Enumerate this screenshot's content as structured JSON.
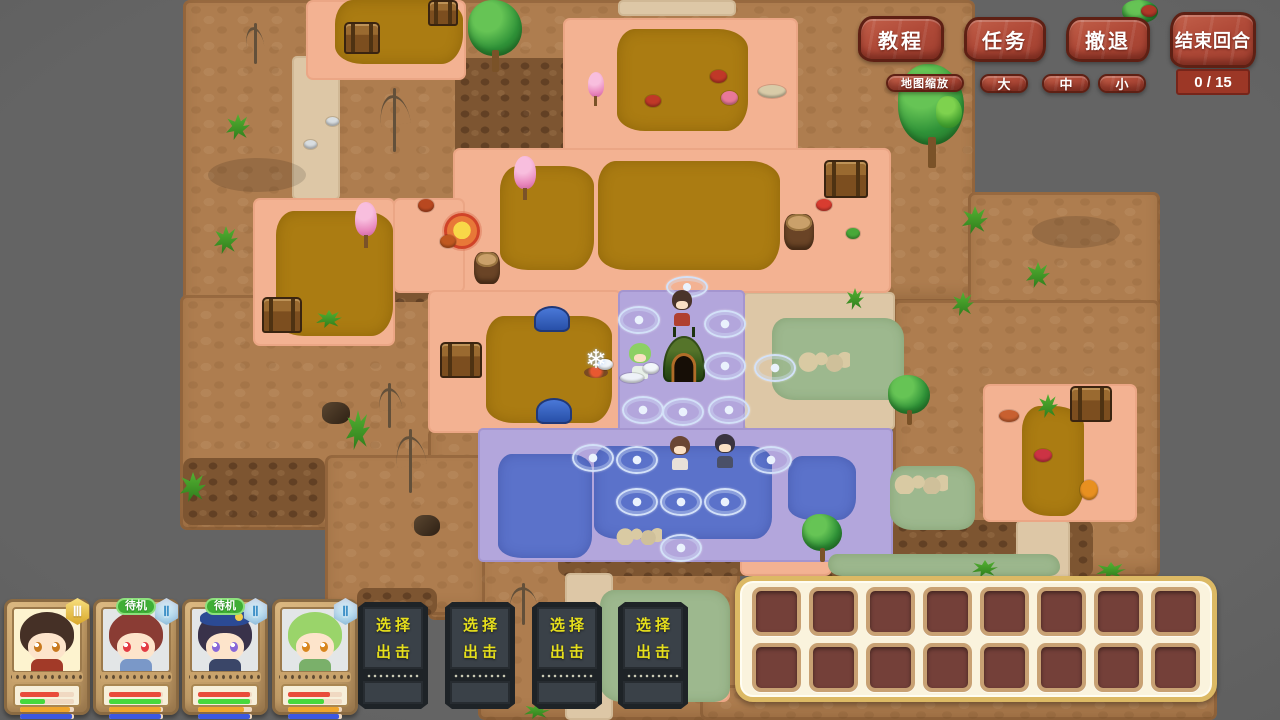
{
  "hud": {
    "buttons": [
      {
        "id": "tutorial",
        "label": "教程"
      },
      {
        "id": "tasks",
        "label": "任务"
      },
      {
        "id": "retreat",
        "label": "撤退"
      },
      {
        "id": "end-turn",
        "label": "结束回合"
      }
    ],
    "turn_counter": "0 / 15",
    "map_zoom": {
      "label": "地图缩放",
      "options": [
        "大",
        "中",
        "小"
      ]
    },
    "accent_color": "#b04a38"
  },
  "party": {
    "standby_label": "待机",
    "sortie_label": [
      "选择",
      "出击"
    ],
    "sortie_slot_count": 4,
    "cards": [
      {
        "id": "char-1",
        "standby": false,
        "badge": "Ⅲ",
        "badge_style": "gold",
        "bg": "#fdf3cf",
        "hair": "#453026",
        "eye": "#c8791f",
        "outfit": "#a23a28",
        "hat": null,
        "bars": [
          {
            "color": "#e94b3b",
            "pct": 72
          },
          {
            "color": "#46d93c",
            "pct": 46
          },
          {
            "color": "#f0a62d",
            "pct": 93
          },
          {
            "color": "#3c58e0",
            "pct": 96
          }
        ]
      },
      {
        "id": "char-2",
        "standby": true,
        "badge": "Ⅱ",
        "badge_style": "blue",
        "bg": "#e3e6e7",
        "hair": "#8a3c34",
        "eye": "#e23b44",
        "outfit": "#7a98c8",
        "hat": null,
        "bars": [
          {
            "color": "#e94b3b",
            "pct": 97
          },
          {
            "color": "#46d93c",
            "pct": 97
          },
          {
            "color": "#f0a62d",
            "pct": 97
          },
          {
            "color": "#3c58e0",
            "pct": 97
          }
        ]
      },
      {
        "id": "char-3",
        "standby": true,
        "badge": "Ⅱ",
        "badge_style": "blue",
        "bg": "#e3e6e7",
        "hair": "#39324a",
        "eye": "#8868d8",
        "outfit": "#3a4668",
        "hat": "#2b4a94",
        "bars": [
          {
            "color": "#e94b3b",
            "pct": 97
          },
          {
            "color": "#46d93c",
            "pct": 97
          },
          {
            "color": "#f0a62d",
            "pct": 85
          },
          {
            "color": "#3c58e0",
            "pct": 97
          }
        ]
      },
      {
        "id": "char-4",
        "standby": false,
        "badge": "Ⅱ",
        "badge_style": "blue",
        "bg": "#e3e6e7",
        "hair": "#9ad46a",
        "eye": "#d8861e",
        "outfit": "#7ab06a",
        "hat": null,
        "bars": [
          {
            "color": "#e94b3b",
            "pct": 78
          },
          {
            "color": "#46d93c",
            "pct": 66
          },
          {
            "color": "#f0a62d",
            "pct": 95
          },
          {
            "color": "#3c58e0",
            "pct": 95
          }
        ]
      }
    ]
  },
  "inventory": {
    "rows": 2,
    "cols": 8
  },
  "map": {
    "palette": {
      "brown": "#ae7d4f",
      "cliff": "#7d5531",
      "beige": "#ddc7a6",
      "pink": "#f3b292",
      "mustard": "#ab7c12",
      "purple": "#b3a6dc",
      "blue": "#5b72ca",
      "green": "#9db88e",
      "background": "#5e5e5e"
    },
    "regions": [
      [
        "brown",
        183,
        0,
        147,
        530
      ],
      [
        "brown",
        330,
        0,
        645,
        302
      ],
      [
        "brown",
        180,
        295,
        302,
        235
      ],
      [
        "brown",
        968,
        192,
        192,
        155
      ],
      [
        "brown",
        893,
        300,
        267,
        277
      ],
      [
        "brown",
        428,
        428,
        62,
        192
      ],
      [
        "brown",
        478,
        550,
        262,
        170
      ],
      [
        "brown",
        325,
        455,
        160,
        160
      ],
      [
        "brown",
        700,
        685,
        517,
        35
      ],
      [
        "cliff",
        455,
        58,
        118,
        155
      ],
      [
        "cliff",
        183,
        458,
        142,
        67
      ],
      [
        "cliff",
        330,
        246,
        100,
        56
      ],
      [
        "cliff",
        357,
        588,
        80,
        27
      ],
      [
        "cliff",
        558,
        536,
        335,
        40
      ],
      [
        "cliff",
        893,
        520,
        200,
        57
      ],
      [
        "beige",
        292,
        56,
        48,
        144
      ],
      [
        "beige",
        618,
        0,
        118,
        16
      ],
      [
        "beige",
        548,
        190,
        30,
        102
      ],
      [
        "beige",
        743,
        292,
        152,
        138
      ],
      [
        "beige",
        565,
        573,
        48,
        147
      ],
      [
        "beige",
        1016,
        520,
        54,
        60
      ],
      [
        "pink",
        306,
        0,
        160,
        80
      ],
      [
        "pink",
        563,
        18,
        235,
        138
      ],
      [
        "pink",
        453,
        148,
        438,
        145
      ],
      [
        "pink",
        253,
        198,
        142,
        148
      ],
      [
        "pink",
        393,
        198,
        72,
        95
      ],
      [
        "pink",
        428,
        290,
        194,
        143
      ],
      [
        "pink",
        983,
        384,
        154,
        138
      ],
      [
        "pink",
        740,
        556,
        92,
        20
      ],
      [
        "pink",
        687,
        607,
        43,
        95
      ],
      [
        "mustard",
        335,
        0,
        128,
        64
      ],
      [
        "mustard",
        617,
        29,
        131,
        102
      ],
      [
        "mustard",
        500,
        166,
        94,
        104
      ],
      [
        "mustard",
        598,
        161,
        182,
        109
      ],
      [
        "mustard",
        276,
        211,
        117,
        125
      ],
      [
        "mustard",
        486,
        316,
        126,
        107
      ],
      [
        "mustard",
        1022,
        406,
        62,
        110
      ],
      [
        "purple",
        618,
        290,
        127,
        145
      ],
      [
        "purple",
        478,
        428,
        415,
        134
      ],
      [
        "blue",
        498,
        454,
        94,
        104
      ],
      [
        "blue",
        594,
        446,
        178,
        93
      ],
      [
        "blue",
        788,
        456,
        68,
        64
      ],
      [
        "green",
        772,
        318,
        132,
        82
      ],
      [
        "green",
        890,
        466,
        85,
        64
      ],
      [
        "green",
        828,
        554,
        232,
        22
      ],
      [
        "green",
        600,
        590,
        130,
        112
      ],
      [
        "shade",
        208,
        158,
        98,
        34
      ],
      [
        "shade",
        1032,
        216,
        88,
        32
      ]
    ],
    "objects": [
      [
        "chest",
        344,
        22,
        32,
        28
      ],
      [
        "chest",
        428,
        0,
        26,
        22
      ],
      [
        "chest",
        824,
        160,
        40,
        34
      ],
      [
        "chest",
        262,
        297,
        36,
        32
      ],
      [
        "chest",
        440,
        342,
        38,
        32
      ],
      [
        "chest",
        1070,
        386,
        38,
        32
      ],
      [
        "tree",
        468,
        0,
        54,
        72
      ],
      [
        "tree",
        898,
        64,
        66,
        104
      ],
      [
        "tree",
        888,
        375,
        42,
        50
      ],
      [
        "tree",
        802,
        514,
        40,
        48
      ],
      [
        "tree",
        1122,
        0,
        36,
        30
      ],
      [
        "bush",
        936,
        96,
        26,
        32
      ],
      [
        "pinktree",
        585,
        72,
        22,
        34
      ],
      [
        "pinktree",
        511,
        156,
        28,
        44
      ],
      [
        "pinktree",
        352,
        202,
        28,
        46
      ],
      [
        "tent",
        663,
        336,
        42,
        46
      ],
      [
        "campfire",
        576,
        350,
        40,
        30
      ],
      [
        "shell",
        534,
        306,
        32,
        22
      ],
      [
        "shell",
        536,
        398,
        32,
        22
      ],
      [
        "spinner",
        444,
        213,
        30,
        30
      ],
      [
        "stump",
        474,
        252,
        26,
        32
      ],
      [
        "stump",
        784,
        214,
        30,
        36
      ],
      [
        "rock",
        322,
        402,
        28,
        22
      ],
      [
        "rock",
        414,
        515,
        26,
        21
      ],
      [
        "bones",
        798,
        350,
        52,
        22
      ],
      [
        "bones",
        616,
        527,
        46,
        18
      ],
      [
        "bones",
        894,
        474,
        54,
        20
      ],
      [
        "deadtree",
        374,
        380,
        30,
        48
      ],
      [
        "deadtree",
        390,
        425,
        40,
        68
      ],
      [
        "deadtree",
        374,
        84,
        40,
        68
      ],
      [
        "deadtree",
        505,
        580,
        36,
        45
      ],
      [
        "deadtree",
        242,
        20,
        24,
        44
      ],
      [
        "plant",
        226,
        114,
        24,
        26
      ],
      [
        "plant",
        214,
        226,
        24,
        28
      ],
      [
        "plant",
        180,
        472,
        26,
        30
      ],
      [
        "plant",
        962,
        206,
        26,
        28
      ],
      [
        "plant",
        1026,
        262,
        24,
        26
      ],
      [
        "plant",
        952,
        292,
        22,
        24
      ],
      [
        "plant",
        846,
        288,
        18,
        22
      ],
      [
        "plant",
        346,
        410,
        24,
        40
      ],
      [
        "plant",
        316,
        310,
        26,
        18
      ],
      [
        "plant",
        1038,
        394,
        20,
        24
      ],
      [
        "plant",
        972,
        560,
        26,
        17
      ],
      [
        "plant",
        1096,
        562,
        30,
        17
      ],
      [
        "plant",
        524,
        703,
        26,
        16
      ],
      [
        "snowflake",
        618,
        306,
        38,
        24
      ],
      [
        "snowflake",
        704,
        310,
        38,
        24
      ],
      [
        "snowflake",
        704,
        352,
        38,
        24
      ],
      [
        "snowflake",
        754,
        354,
        38,
        24
      ],
      [
        "snowflake",
        622,
        396,
        38,
        24
      ],
      [
        "snowflake",
        662,
        398,
        38,
        24
      ],
      [
        "snowflake",
        708,
        396,
        38,
        24
      ],
      [
        "snowflake",
        666,
        276,
        38,
        18
      ],
      [
        "snowflake",
        572,
        444,
        38,
        24
      ],
      [
        "snowflake",
        616,
        446,
        38,
        24
      ],
      [
        "snowflake",
        750,
        446,
        38,
        24
      ],
      [
        "snowflake",
        616,
        488,
        38,
        24
      ],
      [
        "snowflake",
        660,
        488,
        38,
        24
      ],
      [
        "snowflake",
        704,
        488,
        38,
        24
      ],
      [
        "snowflake",
        660,
        534,
        38,
        24
      ],
      [
        "char",
        672,
        290,
        20,
        36,
        "#4a342a",
        "#b04030"
      ],
      [
        "char",
        629,
        343,
        22,
        36,
        "#8cd064",
        "#e8f0e8"
      ],
      [
        "char",
        670,
        436,
        20,
        34,
        "#6a4634",
        "#e8e0d8"
      ],
      [
        "char",
        715,
        434,
        20,
        34,
        "#3a3440",
        "#4a5068"
      ],
      [
        "item",
        816,
        199,
        16,
        12,
        "#d83c30"
      ],
      [
        "item",
        645,
        95,
        16,
        12,
        "#c03828"
      ],
      [
        "item",
        710,
        70,
        17,
        13,
        "#c03828"
      ],
      [
        "item",
        1141,
        5,
        16,
        12,
        "#b03828"
      ],
      [
        "item",
        721,
        91,
        17,
        14,
        "#e87898"
      ],
      [
        "item",
        758,
        85,
        28,
        13,
        "#d8cba8"
      ],
      [
        "item",
        326,
        117,
        13,
        9,
        "#d8dde0"
      ],
      [
        "item",
        304,
        140,
        13,
        9,
        "#d8dde0"
      ],
      [
        "item",
        418,
        199,
        16,
        13,
        "#b84820"
      ],
      [
        "item",
        440,
        235,
        16,
        13,
        "#c05820"
      ],
      [
        "item",
        1034,
        449,
        18,
        13,
        "#cc3344"
      ],
      [
        "item",
        1080,
        480,
        18,
        20,
        "#e89020"
      ],
      [
        "item",
        846,
        228,
        14,
        11,
        "#48a838"
      ],
      [
        "item",
        999,
        410,
        20,
        12,
        "#c86030"
      ],
      [
        "item",
        597,
        359,
        16,
        11,
        "#f2f6fa"
      ],
      [
        "item",
        643,
        363,
        16,
        11,
        "#f2f6fa"
      ],
      [
        "item",
        620,
        373,
        24,
        10,
        "#eef2f8"
      ]
    ]
  }
}
